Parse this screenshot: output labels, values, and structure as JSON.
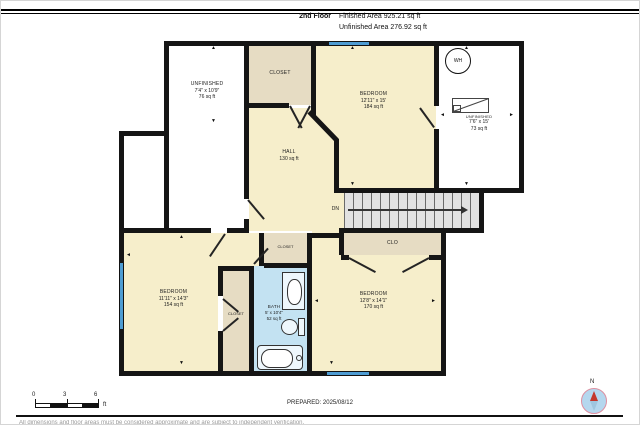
{
  "header": {
    "floor_label": "2nd Floor",
    "finished_area": "Finished Area 925.21 sq ft",
    "unfinished_area": "Unfinished Area 276.92 sq ft"
  },
  "plan": {
    "unfinished_nw": {
      "name": "UNFINISHED",
      "dims": "7'4\" x 10'9\"",
      "area": "76 sq ft"
    },
    "closet_top": {
      "name": "CLOSET"
    },
    "bedroom_ne": {
      "name": "BEDROOM",
      "dims": "12'11\" x 15'",
      "area": "184 sq ft"
    },
    "unfinished_e": {
      "name": "UNFINISHED",
      "dims": "7'6\" x 15'",
      "area": "73 sq ft"
    },
    "water_heater": {
      "label": "WH"
    },
    "hall": {
      "name": "HALL",
      "area": "130 sq ft"
    },
    "stairs": {
      "direction_label": "DN"
    },
    "closet_stairs": {
      "name": "CLO"
    },
    "bedroom_sw": {
      "name": "BEDROOM",
      "dims": "11'11\" x 14'3\"",
      "area": "154 sq ft"
    },
    "closet_sw": {
      "name": "CLOSET"
    },
    "closet_mid": {
      "name": "CLOSET"
    },
    "bath": {
      "name": "BATH",
      "dims": "5' x 10'4\"",
      "area": "52 sq ft"
    },
    "bedroom_se": {
      "name": "BEDROOM",
      "dims": "12'8\" x 14'1\"",
      "area": "170 sq ft"
    }
  },
  "footer": {
    "scale_ticks": [
      "0",
      "3",
      "6"
    ],
    "scale_unit": "ft",
    "prepared": "PREPARED: 2025/08/12",
    "compass_label": "N",
    "disclaimer": "All dimensions and floor areas must be considered approximate and are subject to independent verification."
  },
  "icons": {
    "up": "▲",
    "down": "▼",
    "left": "◄",
    "right": "►"
  },
  "colors": {
    "room": "#F6EECB",
    "closet": "#E6DCC3",
    "bath": "#C3E2F2",
    "stairs": "#E2E2E2",
    "window": "#4E9CD3",
    "wall": "#151515",
    "compass_fill": "#B5D7EE",
    "needle_red": "#C4372C"
  }
}
